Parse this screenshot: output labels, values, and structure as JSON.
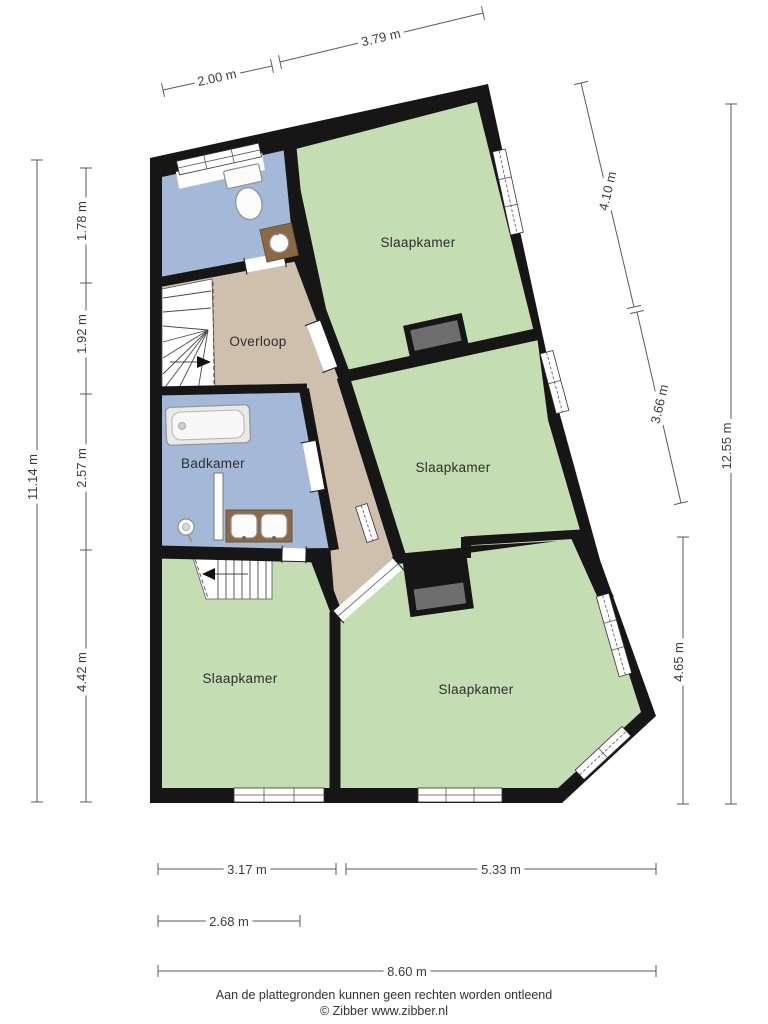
{
  "floorplan": {
    "rooms": [
      {
        "id": "slaapkamer-top-right",
        "label": "Slaapkamer"
      },
      {
        "id": "slaapkamer-middle-right",
        "label": "Slaapkamer"
      },
      {
        "id": "slaapkamer-bottom-left",
        "label": "Slaapkamer"
      },
      {
        "id": "slaapkamer-bottom-right",
        "label": "Slaapkamer"
      },
      {
        "id": "overloop",
        "label": "Overloop"
      },
      {
        "id": "badkamer",
        "label": "Badkamer"
      }
    ],
    "dimensions": {
      "top": [
        {
          "label": "3.79 m"
        },
        {
          "label": "2.00 m"
        }
      ],
      "left": [
        {
          "label": "1.78 m"
        },
        {
          "label": "1.92 m"
        },
        {
          "label": "2.57 m"
        },
        {
          "label": "4.42 m"
        },
        {
          "label": "11.14 m"
        }
      ],
      "right": [
        {
          "label": "4.10 m"
        },
        {
          "label": "3.66 m"
        },
        {
          "label": "12.55 m"
        },
        {
          "label": "4.65 m"
        }
      ],
      "bottom": [
        {
          "label": "3.17 m"
        },
        {
          "label": "5.33 m"
        },
        {
          "label": "2.68 m"
        },
        {
          "label": "8.60 m"
        }
      ]
    },
    "footer": {
      "disclaimer": "Aan de plattegronden kunnen geen rechten worden ontleend",
      "copyright": "© Zibber www.zibber.nl"
    },
    "colors": {
      "wall": "#161616",
      "bedroom": "#c5ddb2",
      "bath": "#a4b9d7",
      "hall": "#cfc0ae",
      "chimney": "#6e6e6e",
      "wood": "#8a6a45",
      "stairs": "#ffffff"
    }
  }
}
